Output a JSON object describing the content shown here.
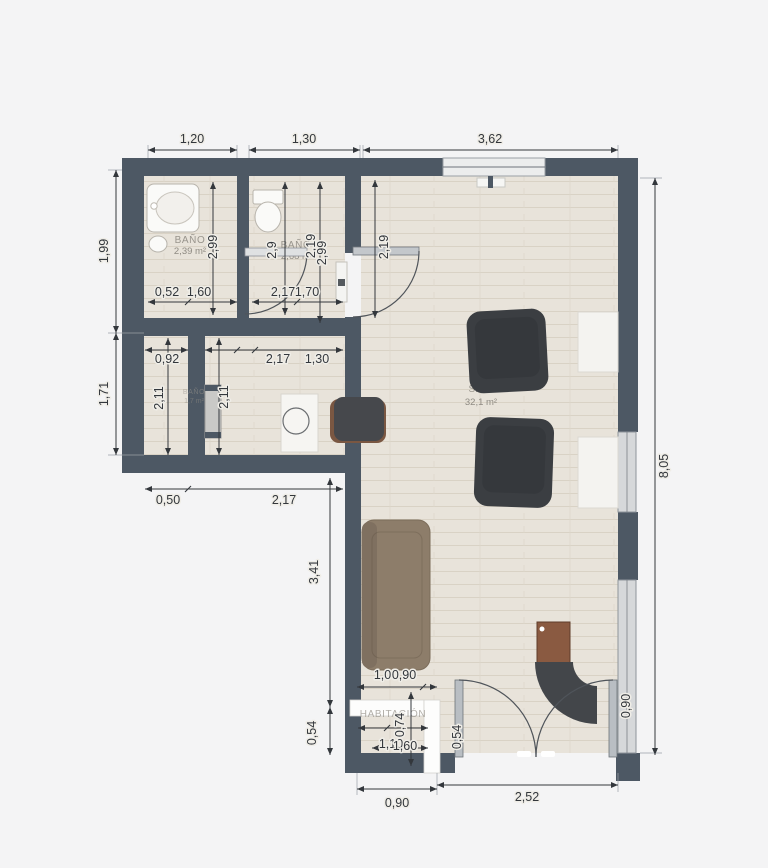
{
  "title": "Plano de vivienda",
  "colors": {
    "wall": "#4d5864",
    "floor": "#e8e3da",
    "background": "#f4f4f5",
    "sofa": "#8d7d6a",
    "armchair": "#3b3e42",
    "wood_cabinet": "#8a5a41",
    "desk": "#43464a",
    "window": "#d6d8da"
  },
  "plan": {
    "rooms": {
      "bath1": {
        "name": "BAÑO",
        "area": "2,39 m²"
      },
      "bath2": {
        "name": "BAÑO",
        "area": "2,68 m²"
      },
      "closet": {
        "name": "BAÑO",
        "area": "1,7 m²"
      },
      "salon": {
        "name": "SALÓN",
        "area": "32,1 m²"
      },
      "bedroom": {
        "name": "HABITACIÓN"
      }
    },
    "dims": {
      "top_1": "1,20",
      "top_2": "1,30",
      "top_3": "3,62",
      "left_1": "1,99",
      "left_2": "1,71",
      "right_1": "8,05",
      "bottom_1": "0,90",
      "bottom_2": "2,52",
      "in_top_1": "0,52",
      "in_top_2": "1,60",
      "in_top_3": "2,17",
      "in_top_4": "1,70",
      "in_mid_1": "0,92",
      "in_mid_2": "2,17",
      "in_mid_3": "1,30",
      "in_low_1": "0,50",
      "in_low_2": "2,17",
      "v_bath1": "2,99",
      "v_bath2": "2,9",
      "v_hall_1": "2,19",
      "v_hall_2": "2,99",
      "v_door": "2,19",
      "v_closet_1": "2,11",
      "v_closet_2": "2,11",
      "v_sofa": "3,41",
      "v_door_low": "0,54",
      "sofa_w_1": "1,00",
      "sofa_w_2": "0,90",
      "bed_h": "0,74",
      "bed_w_1": "1,10",
      "bed_w_2": "1,60",
      "leaf_h": "0,54",
      "win_h": "0,90"
    }
  }
}
